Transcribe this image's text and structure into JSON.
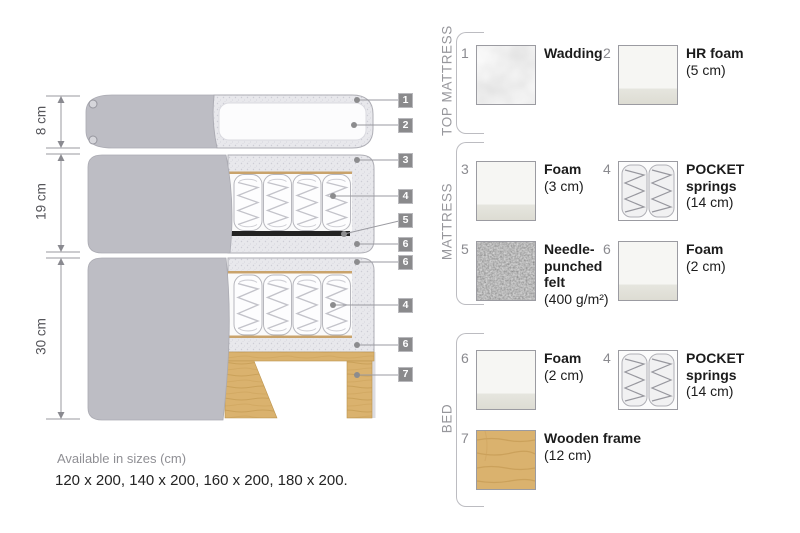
{
  "diagram": {
    "dimension_labels": [
      "8 cm",
      "19 cm",
      "30 cm"
    ],
    "tags": [
      "1",
      "2",
      "3",
      "4",
      "5",
      "6",
      "6",
      "4",
      "6",
      "7"
    ]
  },
  "legend": {
    "sections": [
      {
        "title": "TOP MATTRESS",
        "items": [
          {
            "num": "1",
            "name": "Wadding",
            "detail": "",
            "thumb": "wadding-texture"
          },
          {
            "num": "2",
            "name": "HR foam",
            "detail": "(5 cm)",
            "thumb": "foam-block"
          }
        ]
      },
      {
        "title": "MATTRESS",
        "items": [
          {
            "num": "3",
            "name": "Foam",
            "detail": "(3 cm)",
            "thumb": "foam-block"
          },
          {
            "num": "4",
            "name": "POCKET springs",
            "detail": "(14 cm)",
            "thumb": "pocket-springs"
          },
          {
            "num": "5",
            "name": "Needle-punched felt",
            "detail": "(400 g/m²)",
            "thumb": "felt-texture"
          },
          {
            "num": "6",
            "name": "Foam",
            "detail": "(2 cm)",
            "thumb": "foam-block"
          }
        ]
      },
      {
        "title": "BED",
        "items": [
          {
            "num": "6",
            "name": "Foam",
            "detail": "(2 cm)",
            "thumb": "foam-block"
          },
          {
            "num": "4",
            "name": "POCKET springs",
            "detail": "(14 cm)",
            "thumb": "pocket-springs"
          },
          {
            "num": "7",
            "name": "Wooden frame",
            "detail": "(12 cm)",
            "thumb": "wood-texture"
          }
        ]
      }
    ]
  },
  "footer": {
    "sizes_label": "Available in sizes (cm)",
    "sizes_value": "120 x 200, 140 x 200, 160 x 200, 180 x 200."
  },
  "colors": {
    "cover_gray": "#bdbdc4",
    "foam_texture": "#e8e8ec",
    "wood": "#dab26e",
    "felt_black": "#222222",
    "tag_bg": "#8a8a8c",
    "leader_line": "#9a9aa0"
  }
}
